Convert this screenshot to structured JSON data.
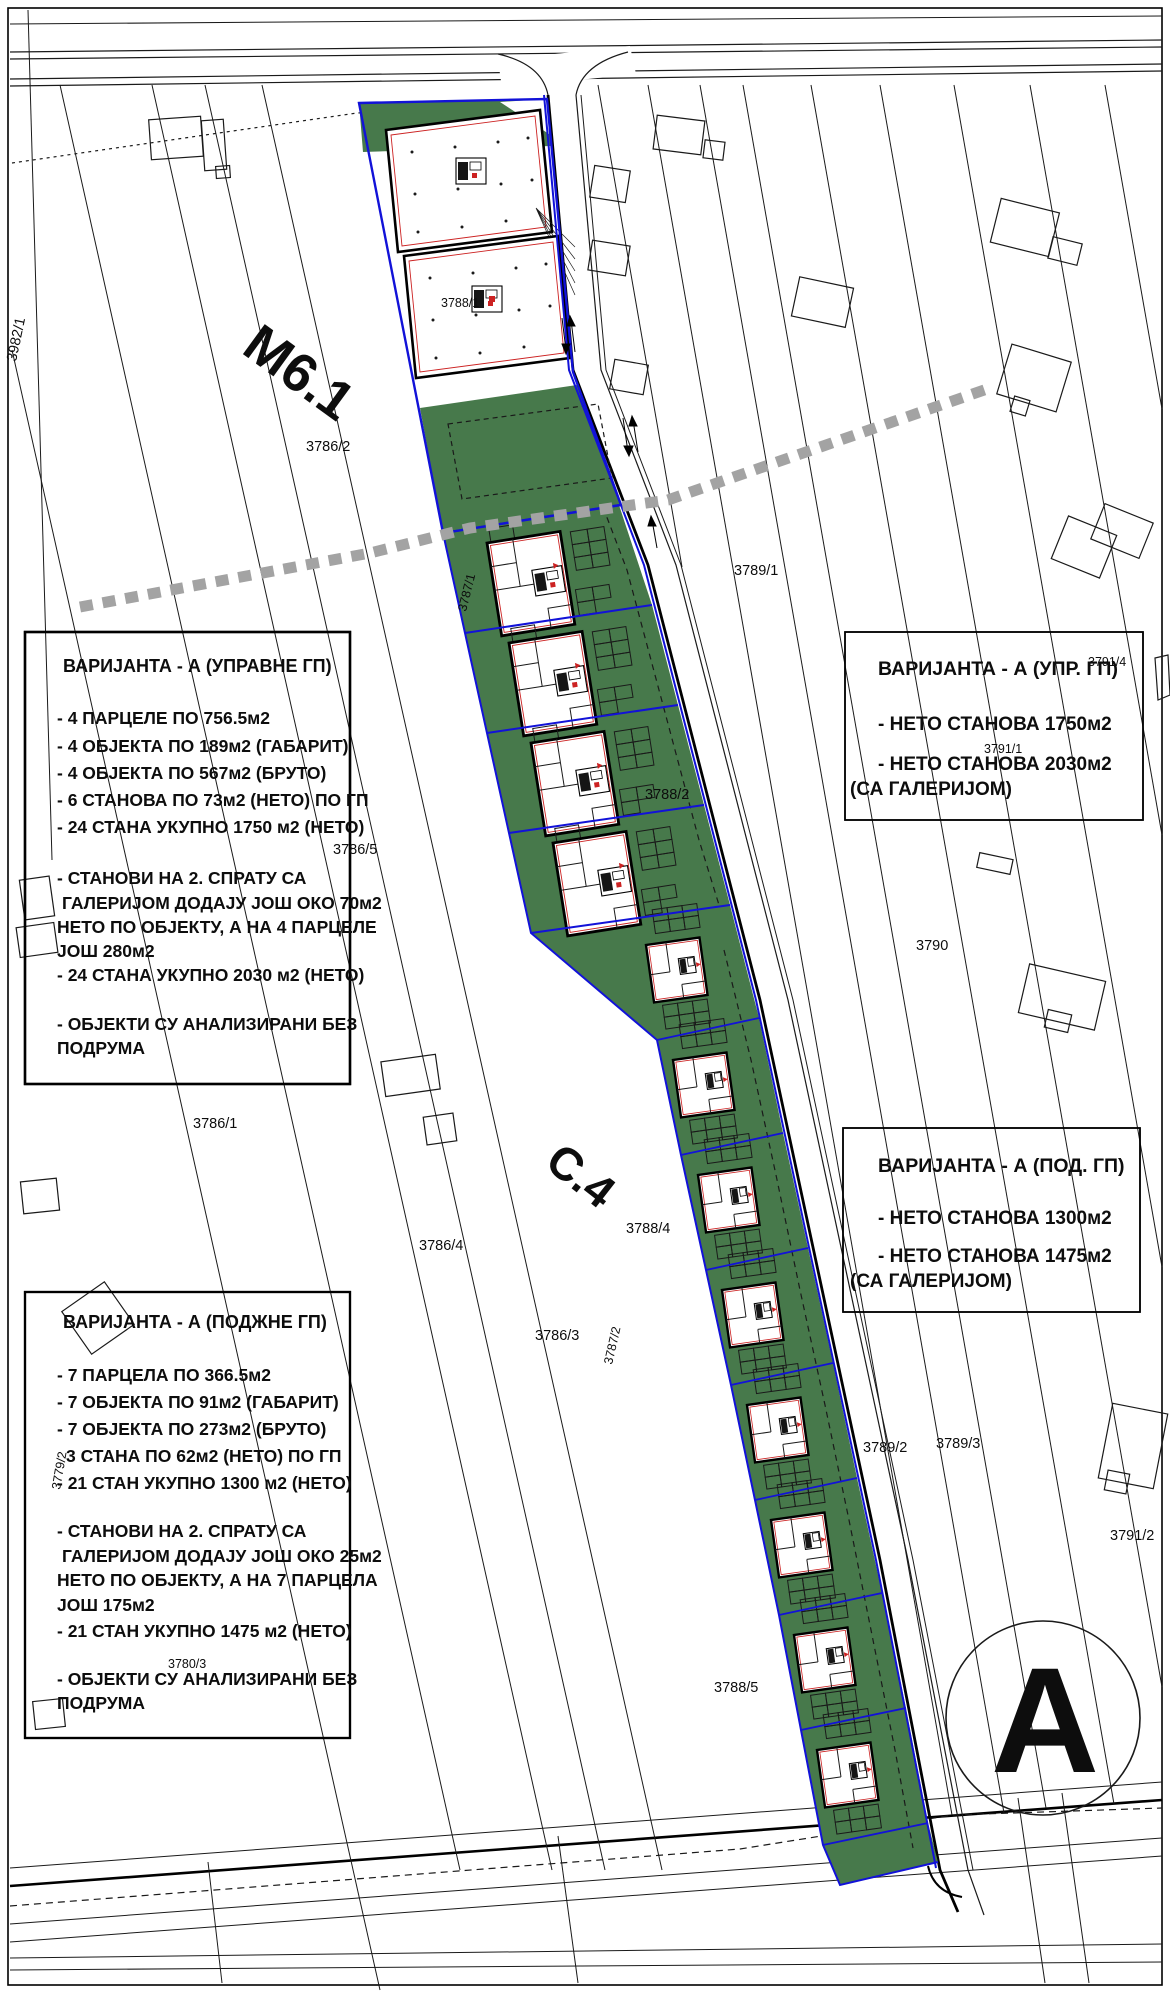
{
  "drawing": {
    "type": "urban-plan-site-drawing",
    "sheet_letter": "А",
    "zone_label_1": "М6.1",
    "zone_label_2": "С.4"
  },
  "colors": {
    "green_area": "#47794b",
    "parcel_blue": "#1212d8",
    "detail_red": "#cc2222",
    "gray_dash": "#a3a3a3",
    "line_black": "#1a1a1a"
  },
  "box_upravne": {
    "title": "ВАРИЈАНТА - А (УПРАВНЕ ГП)",
    "lines": [
      "- 4 ПАРЦЕЛЕ ПО 756.5м2",
      "- 4 ОБЈЕКТА ПО 189м2 (ГАБАРИТ)",
      "- 4 ОБЈЕКТА ПО 567м2 (БРУТО)",
      "- 6 СТАНОВА ПО 73м2 (НЕТО) ПО ГП",
      "- 24 СТАНА УКУПНО 1750 м2 (НЕТО)",
      "- СТАНОВИ НА 2. СПРАТУ СА",
      " ГАЛЕРИЈОМ ДОДАЈУ ЈОШ ОКО 70м2",
      "НЕТО ПО ОБЈЕКТУ, А НА 4 ПАРЦЕЛЕ",
      "ЈОШ 280м2",
      "- 24 СТАНА УКУПНО 2030 м2 (НЕТО)",
      "- ОБЈЕКТИ СУ АНАЛИЗИРАНИ БЕЗ",
      "ПОДРУМА"
    ]
  },
  "box_upr": {
    "title": "ВАРИЈАНТА - А (УПР. ГП)",
    "lines": [
      "- НЕТО СТАНОВА 1750м2",
      "- НЕТО СТАНОВА 2030м2",
      "(СА ГАЛЕРИЈОМ)"
    ]
  },
  "box_pod": {
    "title": "ВАРИЈАНТА - А (ПОД. ГП)",
    "lines": [
      "- НЕТО СТАНОВА 1300м2",
      "- НЕТО СТАНОВА 1475м2",
      "(СА ГАЛЕРИЈОМ)"
    ]
  },
  "box_podzne": {
    "title": "ВАРИЈАНТА - А (ПОДЖНЕ ГП)",
    "lines": [
      "- 7 ПАРЦЕЛА ПО 366.5м2",
      "- 7 ОБЈЕКТА ПО 91м2 (ГАБАРИТ)",
      "- 7 ОБЈЕКТА ПО 273м2 (БРУТО)",
      "3 СТАНА ПО 62м2 (НЕТО) ПО ГП",
      "- 21 СТАН УКУПНО 1300 м2 (НЕТО)",
      "- СТАНОВИ НА 2. СПРАТУ СА",
      " ГАЛЕРИЈОМ ДОДАЈУ ЈОШ ОКО 25м2",
      "НЕТО ПО ОБЈЕКТУ, А НА 7 ПАРЦЕЛА",
      "ЈОШ 175м2",
      "- 21 СТАН УКУПНО 1475 м2 (НЕТО)",
      "- ОБЈЕКТИ СУ АНАЛИЗИРАНИ БЕЗ",
      "ПОДРУМА"
    ]
  },
  "parcel_labels": [
    "3982/1",
    "3786/2",
    "3788/1",
    "3789/1",
    "3791/1",
    "3791/4",
    "3787/1",
    "3788/2",
    "3786/5",
    "3790",
    "3786/1",
    "3786/4",
    "3788/4",
    "3786/3",
    "3787/2",
    "3789/2",
    "3789/3",
    "3791/2",
    "3779/2",
    "3780/3",
    "3788/5"
  ]
}
